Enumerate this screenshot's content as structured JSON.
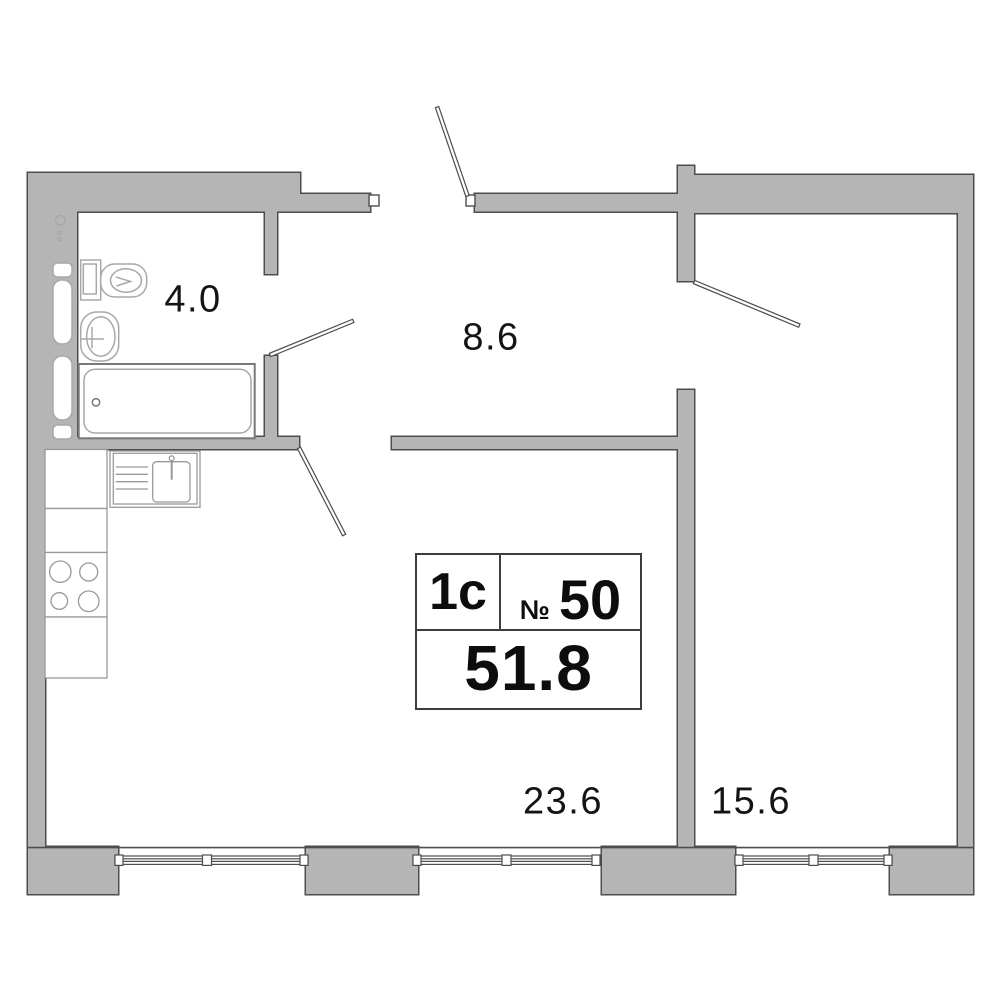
{
  "floorplan": {
    "unit": {
      "type_label": "1с",
      "number_prefix": "№",
      "number": "50",
      "total_area": "51.8"
    },
    "rooms": [
      {
        "name": "bathroom",
        "area_label": "4.0"
      },
      {
        "name": "hallway",
        "area_label": "8.6"
      },
      {
        "name": "kitchen-living-room",
        "area_label": "23.6"
      },
      {
        "name": "bedroom",
        "area_label": "15.6"
      }
    ],
    "colors": {
      "wall_fill": "#b5b5b5",
      "wall_outline": "#4d4d4d",
      "fixture_outline": "#a8a8a8",
      "bathtub_outline": "#787878",
      "label_text": "#141414",
      "info_box_border": "#3d3d3d"
    }
  }
}
